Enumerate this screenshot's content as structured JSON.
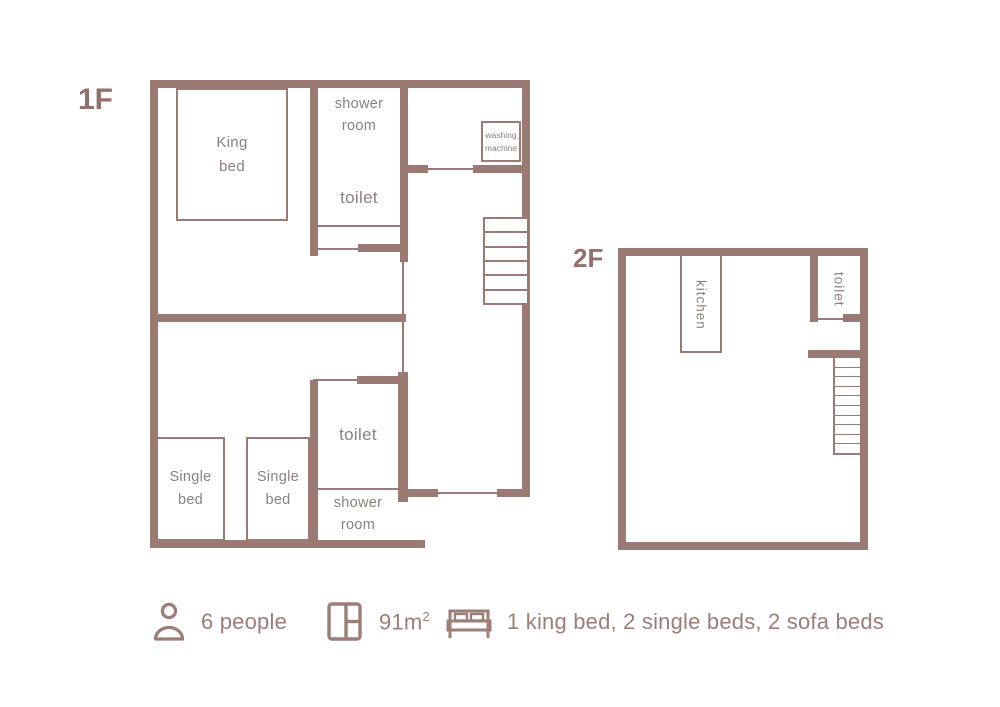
{
  "colors": {
    "wall": "#9b7a74",
    "room_label": "#8b817d",
    "floor_tag": "#946f6b",
    "legend_text": "#9c7e77"
  },
  "floors": {
    "f1": {
      "label": "1F",
      "stairs_steps": 6,
      "rooms": {
        "king_bed": "King bed",
        "shower_room_top": "shower room",
        "toilet_top": "toilet",
        "washing_machine": "washing machine",
        "toilet_bottom": "toilet",
        "shower_room_bottom": "shower room",
        "single_bed_left": "Single bed",
        "single_bed_right": "Single bed"
      }
    },
    "f2": {
      "label": "2F",
      "stairs_steps": 10,
      "rooms": {
        "kitchen": "kitchen",
        "toilet": "toilet"
      }
    }
  },
  "legend": {
    "people": {
      "icon": "person-icon",
      "text": "6 people"
    },
    "area": {
      "icon": "floor-area-icon",
      "value": "91m",
      "sup": "2"
    },
    "beds": {
      "icon": "bed-icon",
      "text": "1 king bed, 2 single beds, 2 sofa beds"
    }
  }
}
